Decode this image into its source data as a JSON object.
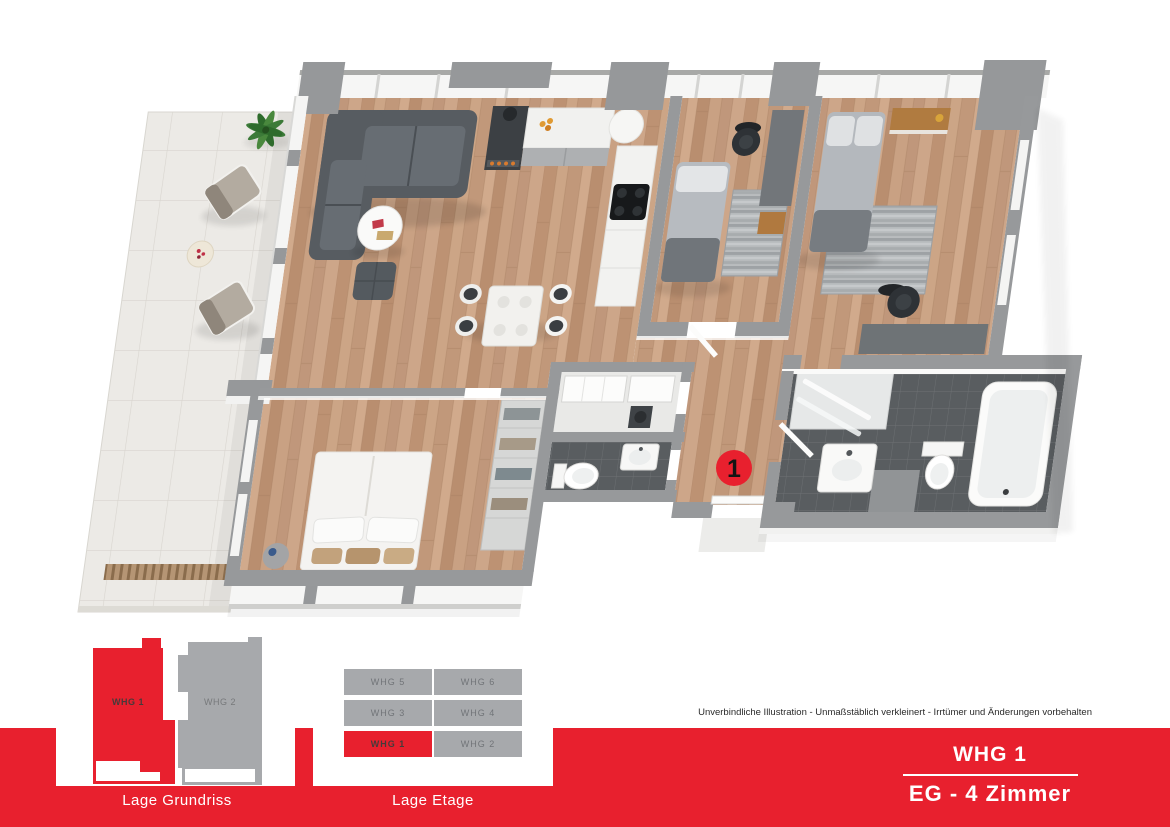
{
  "floorplan": {
    "unit_marker": "1"
  },
  "location_plan": {
    "title": "Lage Grundriss",
    "units": [
      {
        "label": "WHG 1",
        "highlighted": true
      },
      {
        "label": "WHG 2",
        "highlighted": false
      }
    ]
  },
  "etage": {
    "title": "Lage Etage",
    "rows": [
      [
        "WHG 5",
        "WHG 6"
      ],
      [
        "WHG 3",
        "WHG 4"
      ],
      [
        "WHG 1",
        "WHG 2"
      ]
    ],
    "active": "WHG 1"
  },
  "disclaimer": "Unverbindliche Illustration - Unmaßstäblich verkleinert - Irrtümer und Änderungen vorbehalten",
  "title_block": {
    "unit": "WHG 1",
    "details": "EG - 4 Zimmer"
  },
  "colors": {
    "accent_red": "#e8202e",
    "unit_gray": "#a7a9ac",
    "wood_floor": "#c59c7e",
    "wall_gray": "#97999b",
    "dark_tile": "#595d60"
  }
}
